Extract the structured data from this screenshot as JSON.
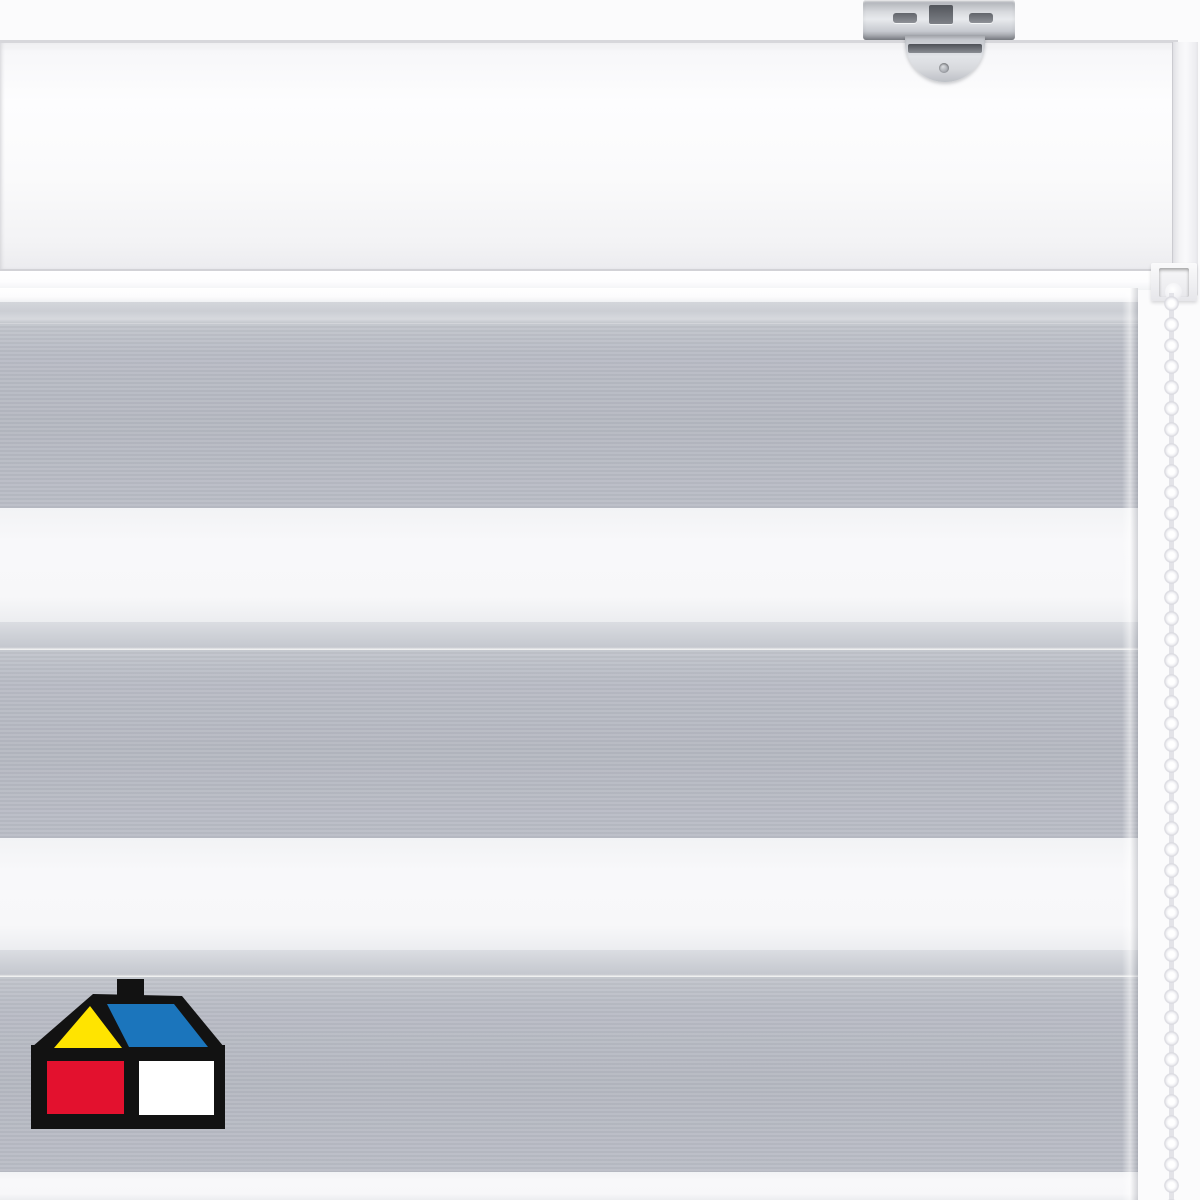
{
  "scene": {
    "description": "Product photo of a white day/night zebra roller blind: white headrail with metal ceiling bracket, white bead pull chain on the right, fabric with alternating gray and sheer white horizontal bands, house-shaped hardware store logo at bottom left",
    "background_color": "#fbfbfc"
  },
  "palette": {
    "background": "#fbfbfc",
    "fabric_gray": "#b5b8c1",
    "fabric_sheer": "#f8f8fa",
    "fabric_overlap": "#ced1d7",
    "fabric_roll": "#cbced4",
    "bead_white": "#f2f2f5",
    "bracket_silver": "#c9ccd1",
    "logo_black": "#121212",
    "logo_yellow": "#ffe400",
    "logo_blue": "#1b75bc",
    "logo_red": "#e3112e",
    "logo_white": "#ffffff"
  },
  "headrail": {
    "color": "#fafafb",
    "edge_color": "#d7d7db"
  },
  "chain": {
    "bead_color": "#f2f2f5",
    "bead_pitch_px": 21,
    "bead_diameter_px": 14,
    "side": "right"
  },
  "fabric": {
    "top": 288,
    "right_edge_px": 1138,
    "stripes": [
      {
        "name": "fabric-top-highlight",
        "type": "white",
        "top": 288,
        "height": 14
      },
      {
        "name": "fabric-roll-edge",
        "type": "roll",
        "top": 302,
        "height": 22
      },
      {
        "name": "solid-band-1",
        "type": "gray",
        "top": 324,
        "height": 184
      },
      {
        "name": "sheer-band-1",
        "type": "sheer",
        "top": 508,
        "height": 114
      },
      {
        "name": "overlap-strip-1",
        "type": "overlap",
        "top": 622,
        "height": 28
      },
      {
        "name": "solid-band-2",
        "type": "gray",
        "top": 650,
        "height": 188
      },
      {
        "name": "sheer-band-2",
        "type": "sheer",
        "top": 838,
        "height": 112
      },
      {
        "name": "overlap-strip-2",
        "type": "overlap",
        "top": 950,
        "height": 27
      },
      {
        "name": "solid-band-3",
        "type": "gray",
        "top": 977,
        "height": 195
      },
      {
        "name": "sheer-band-3",
        "type": "sheer",
        "top": 1172,
        "height": 28
      }
    ]
  },
  "logo": {
    "name": "homecenter-house-logo",
    "position": {
      "left": 31,
      "top": 978,
      "width": 194,
      "height": 151
    },
    "colors": {
      "outline": "#121212",
      "gable": "#ffe400",
      "roof": "#1b75bc",
      "left_window": "#e3112e",
      "right_window": "#ffffff"
    }
  }
}
